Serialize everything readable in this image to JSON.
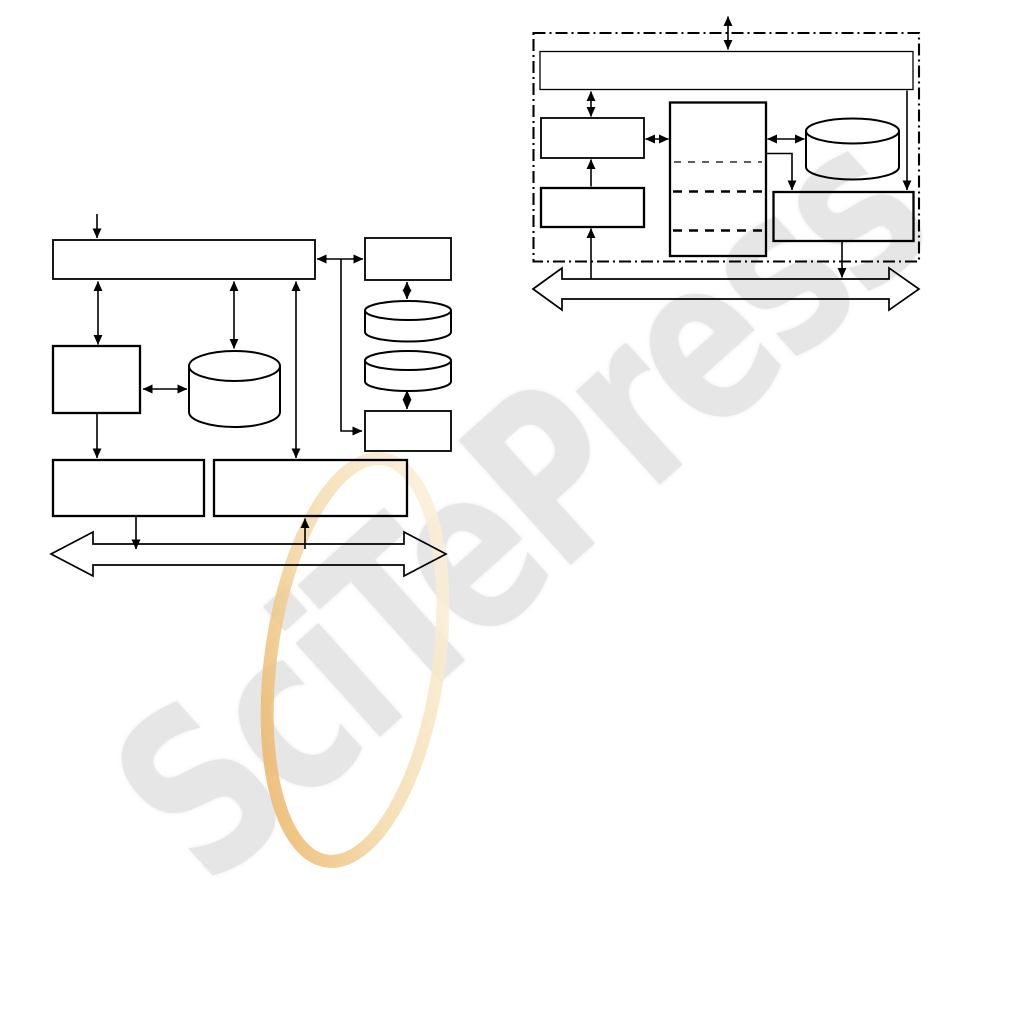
{
  "page": {
    "background_color": "#ffffff",
    "kind": "figure page with two untitled block diagrams"
  },
  "watermark": {
    "text": "SciTePress",
    "text_color": "#e6e6e6",
    "rotation_deg": -42,
    "ring_colors": [
      "#e9a94f",
      "#f3d9a8",
      "#fdf6e5"
    ]
  },
  "left_diagram": {
    "type": "block-diagram",
    "components": [
      {
        "name": "top-wide-box",
        "shape": "rect",
        "label": ""
      },
      {
        "name": "left-square-box",
        "shape": "rect",
        "label": ""
      },
      {
        "name": "main-cylinder",
        "shape": "cylinder",
        "label": ""
      },
      {
        "name": "right-top-box",
        "shape": "rect",
        "label": ""
      },
      {
        "name": "right-cylinder-1",
        "shape": "cylinder",
        "label": ""
      },
      {
        "name": "right-cylinder-2",
        "shape": "cylinder",
        "label": ""
      },
      {
        "name": "right-bottom-box",
        "shape": "rect",
        "label": ""
      },
      {
        "name": "bottom-left-box",
        "shape": "rect",
        "label": ""
      },
      {
        "name": "bottom-right-box",
        "shape": "rect",
        "label": ""
      },
      {
        "name": "bus-double-arrow",
        "shape": "hollow-double-arrow",
        "label": ""
      }
    ],
    "line_color": "#000000",
    "fill": "transparent"
  },
  "right_diagram": {
    "type": "block-diagram",
    "components": [
      {
        "name": "dash-dot-boundary",
        "shape": "dash-dot-rect",
        "label": ""
      },
      {
        "name": "top-wide-box",
        "shape": "rect",
        "label": ""
      },
      {
        "name": "left-box-1",
        "shape": "rect",
        "label": ""
      },
      {
        "name": "left-box-2",
        "shape": "rect",
        "label": ""
      },
      {
        "name": "center-partitioned-box",
        "shape": "rect-with-3-dashed-dividers",
        "label": ""
      },
      {
        "name": "right-cylinder",
        "shape": "cylinder",
        "label": ""
      },
      {
        "name": "bottom-right-box",
        "shape": "rect",
        "label": ""
      },
      {
        "name": "bus-double-arrow",
        "shape": "hollow-double-arrow",
        "label": ""
      }
    ],
    "line_color": "#000000",
    "fill": "transparent"
  }
}
